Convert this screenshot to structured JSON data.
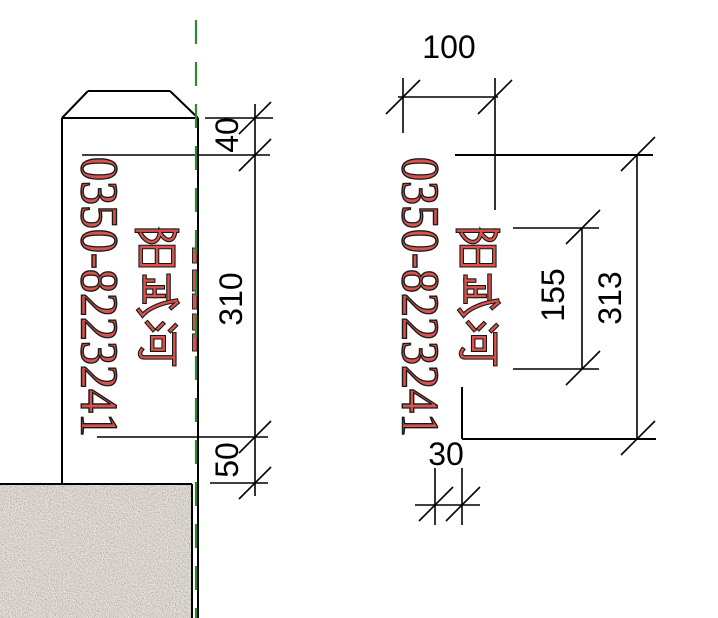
{
  "colors": {
    "text_red": "#d9534c",
    "text_outline": "#000000",
    "centerline_green": "#2f8a2f",
    "line_black": "#000000"
  },
  "left_view": {
    "river_name": "阳武河",
    "phone": "0350-8223241",
    "dim_top": "40",
    "dim_middle": "310",
    "dim_bottom": "50"
  },
  "right_view": {
    "river_name": "阳武河",
    "phone": "0350-8223241",
    "dim_width": "100",
    "dim_inner_height": "155",
    "dim_total_height": "313",
    "dim_offset": "30"
  }
}
